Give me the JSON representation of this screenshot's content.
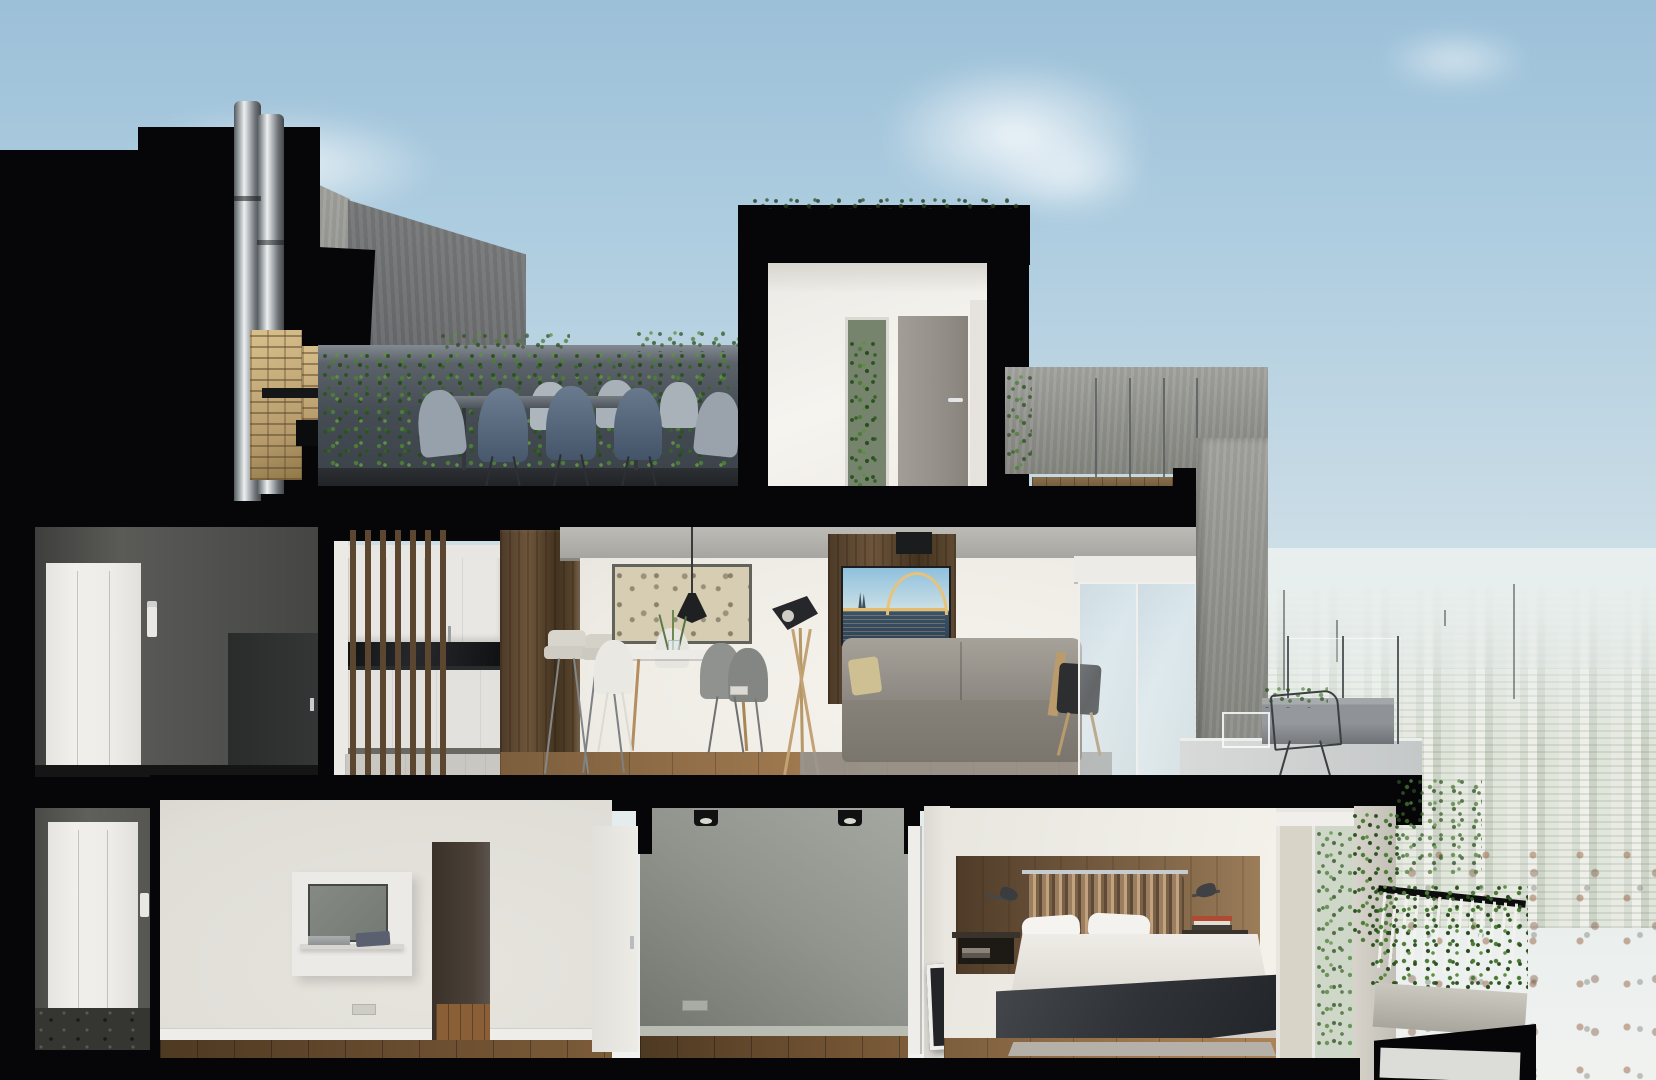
{
  "scene": {
    "kind": "architectural cross-section render of a duplex penthouse with roof terrace and city skyline view",
    "rooms": [
      "roof-terrace",
      "barbecue-corner",
      "stair-bulkhead",
      "elevator-lobby-upper",
      "kitchen",
      "living-dining-room",
      "living-terrace",
      "elevator-lobby-lower",
      "media-room",
      "hallway",
      "multipurpose-room",
      "bedroom",
      "bedroom-balcony"
    ],
    "view": "dense hazy city skyline with antenna masts"
  },
  "sign": {
    "label": "4"
  },
  "tv_scene": {
    "subject": "illuminated arch bridge over river at dusk"
  },
  "palette": {
    "sky_top": "#9cc0d8",
    "sky_horizon": "#f0f2ef",
    "section_cut_black": "#060608",
    "concrete": "#9b9c97",
    "terrace_wall": "#4a5058",
    "ivy_green": "#4c7c36",
    "brick": "#c9b285",
    "chair_shell_blue": "#64758a",
    "wood_panel": "#6d553b",
    "wood_floor": "#a07a50",
    "sofa_gray": "#8f8b84",
    "bridge_gold": "#e6bb69",
    "bed_throw": "#33363a",
    "city_haze": "#e9efee"
  }
}
